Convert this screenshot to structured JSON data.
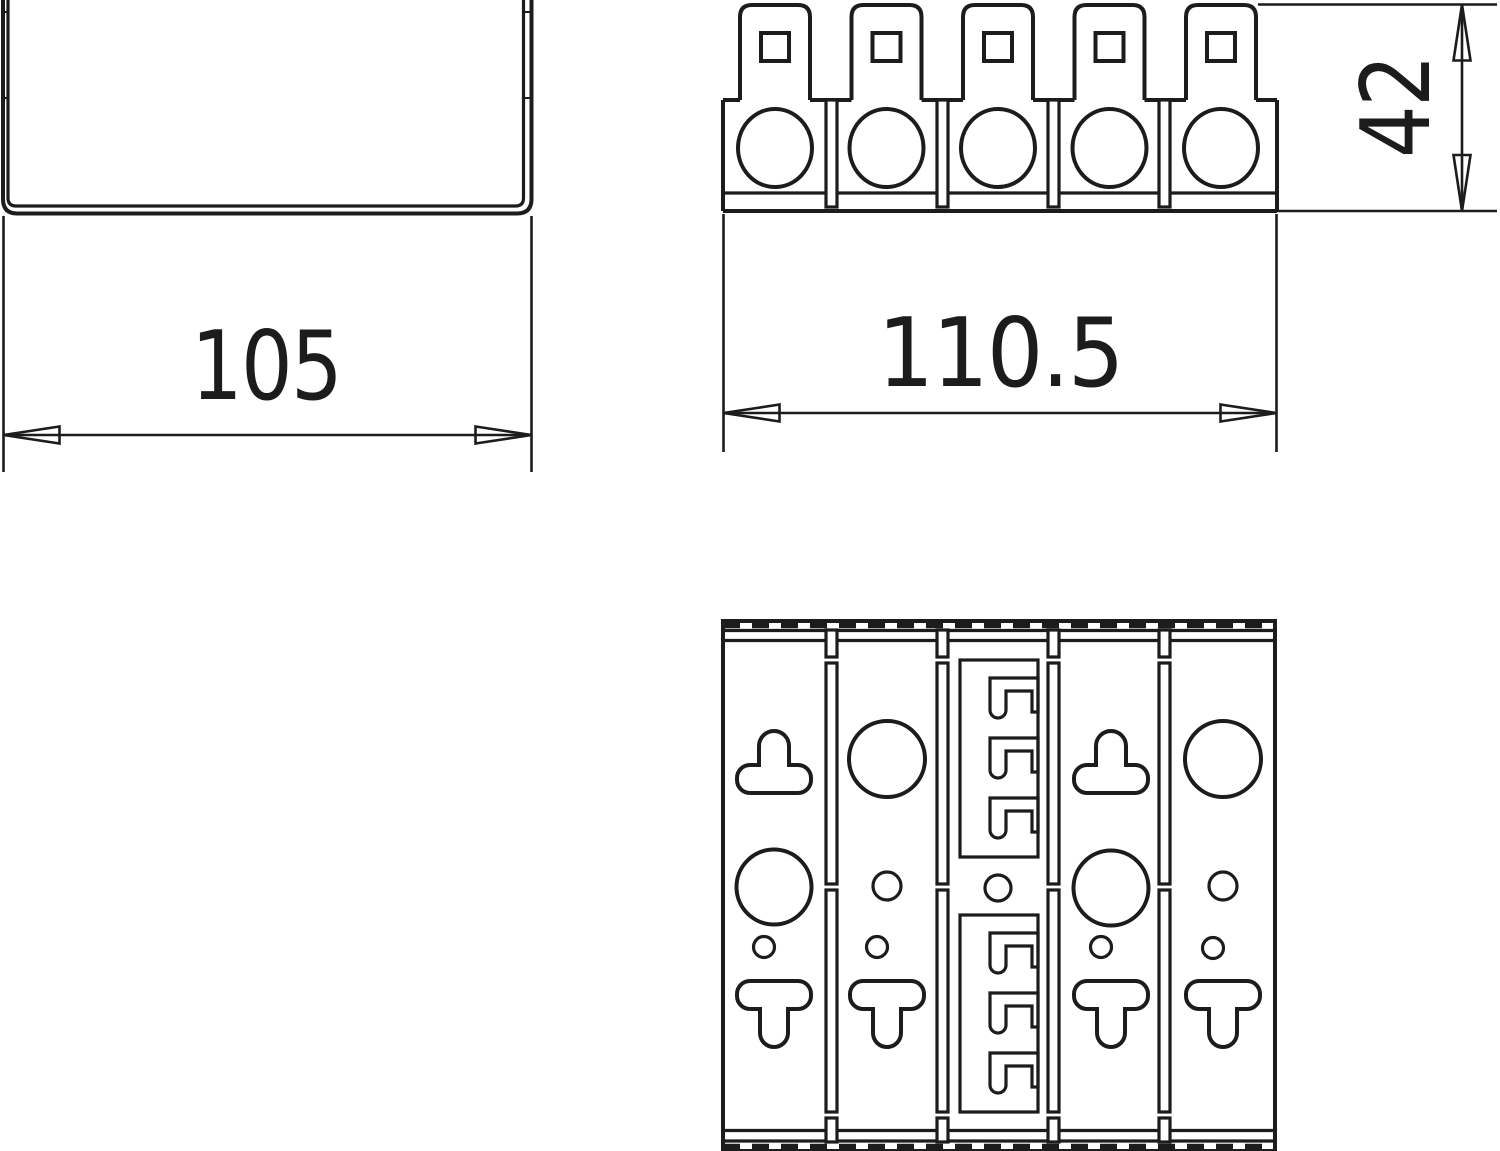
{
  "meta": {
    "background": "#ffffff",
    "line_color": "#1c1c1c",
    "drawing_type": "technical-dimension-drawing"
  },
  "views": {
    "channel_profile": {
      "name": "u-channel-profile-view"
    },
    "terminal_side": {
      "name": "terminal-strip-side-view",
      "pole_count": 5
    },
    "terminal_bottom": {
      "name": "terminal-strip-bottom-view",
      "column_count": 5
    }
  },
  "dimensions": {
    "channel_width": "105",
    "strip_width": "110.5",
    "strip_height": "42"
  }
}
